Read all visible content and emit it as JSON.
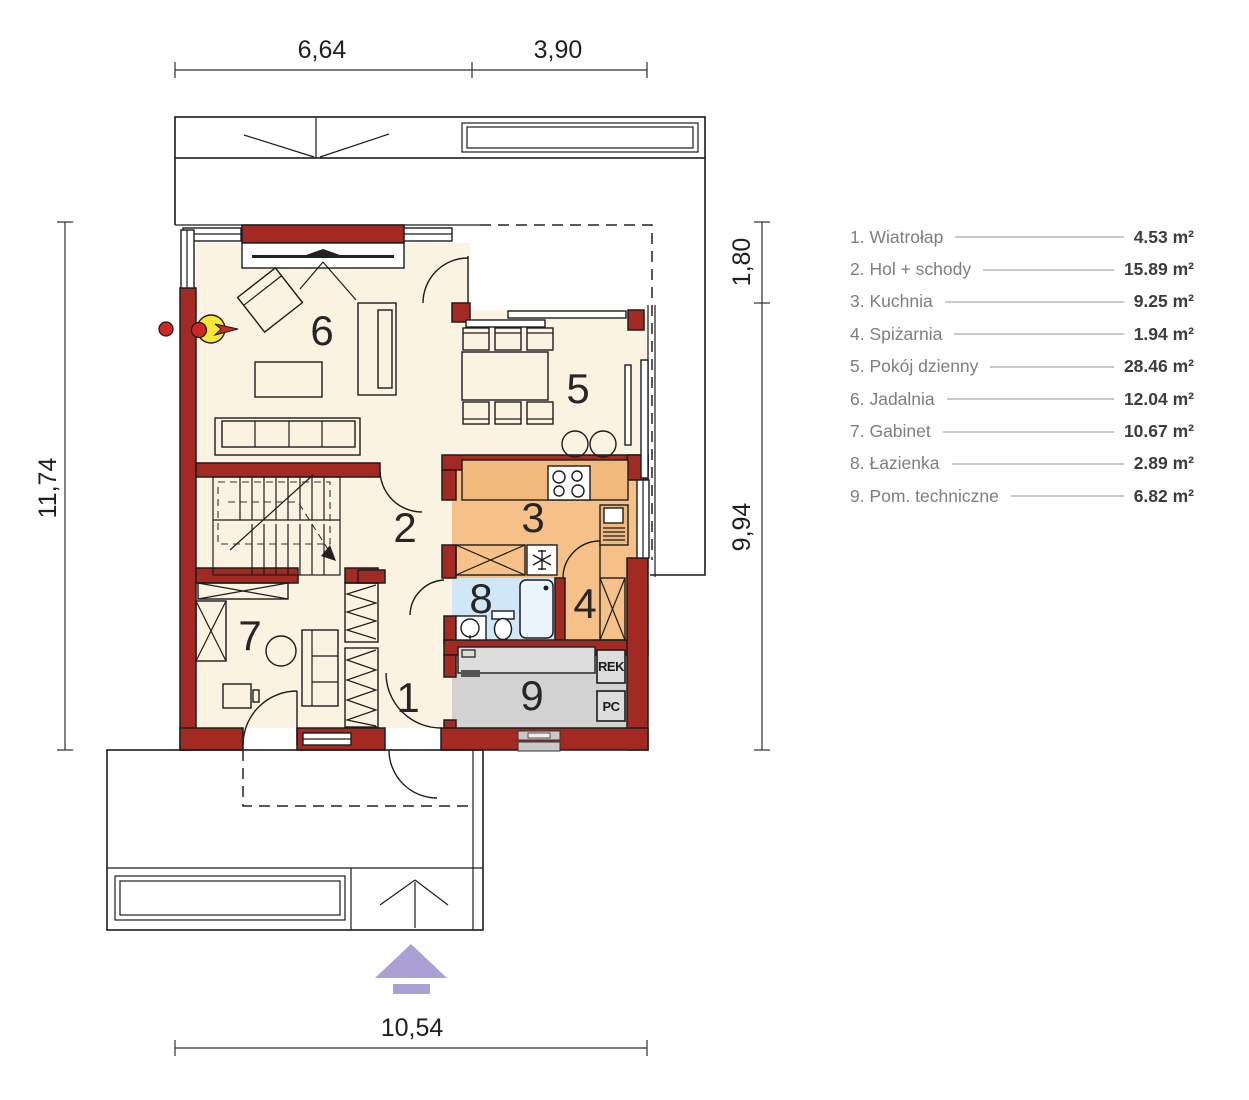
{
  "colors": {
    "wall-red": "#a32a23",
    "room-cream": "#faf3e2",
    "room-orange": "#f6c188",
    "counter-orange": "#f2b97c",
    "room-blue": "#cfe7f6",
    "room-gray": "#d2d2d2",
    "counter-gray": "#dddddd",
    "arrow-purple": "#aba0d3",
    "fireplace-yellow": "#f6e637",
    "flame-red": "#cf2823"
  },
  "dimensions": {
    "top_left": "6,64",
    "top_right": "3,90",
    "left": "11,74",
    "right_upper": "1,80",
    "right_lower": "9,94",
    "bottom": "10,54"
  },
  "rooms": [
    {
      "number": "1",
      "label": "1. Wiatrołap",
      "area": "4.53 m²"
    },
    {
      "number": "2",
      "label": "2. Hol + schody",
      "area": "15.89 m²"
    },
    {
      "number": "3",
      "label": "3. Kuchnia",
      "area": "9.25 m²"
    },
    {
      "number": "4",
      "label": "4. Spiżarnia",
      "area": "1.94 m²"
    },
    {
      "number": "5",
      "label": "5. Pokój dzienny",
      "area": "28.46 m²"
    },
    {
      "number": "6",
      "label": "6. Jadalnia",
      "area": "12.04 m²"
    },
    {
      "number": "7",
      "label": "7. Gabinet",
      "area": "10.67 m²"
    },
    {
      "number": "8",
      "label": "8. Łazienka",
      "area": "2.89 m²"
    },
    {
      "number": "9",
      "label": "9. Pom. techniczne",
      "area": "6.82 m²"
    }
  ],
  "tech_labels": {
    "rek": "REK",
    "pc": "PC"
  }
}
